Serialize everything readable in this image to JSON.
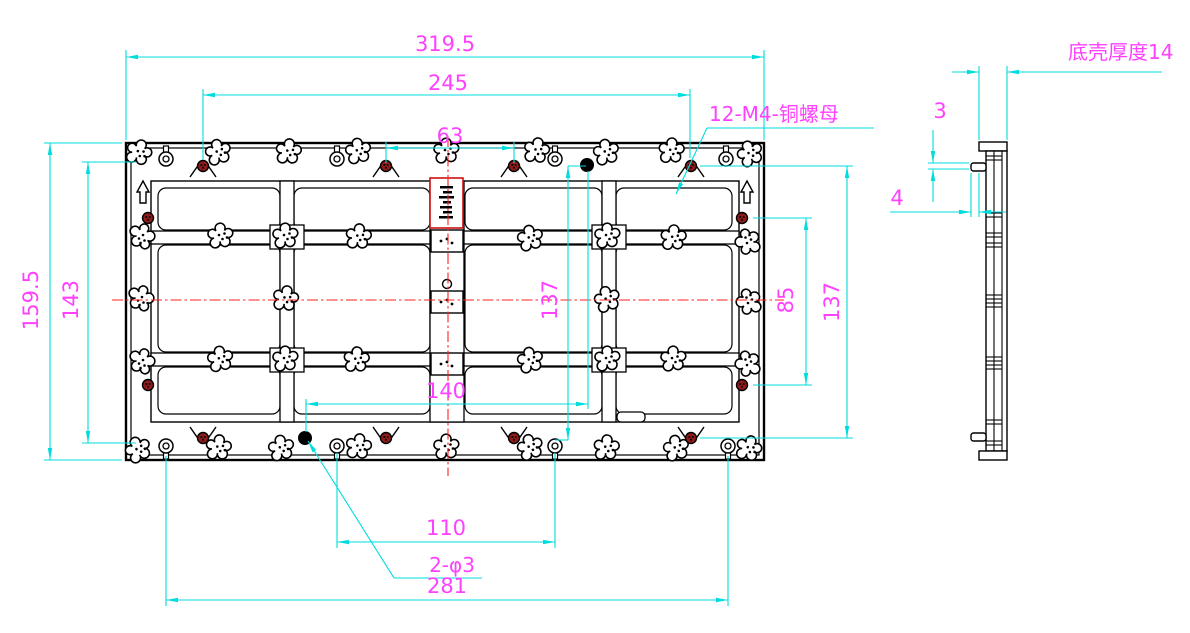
{
  "drawing": {
    "dimensions": {
      "overall_width": "319.5",
      "nut_span_width": "245",
      "center_nut_span": "63",
      "overall_height": "159.5",
      "inner_height": "143",
      "mid_height": "137",
      "right_height": "137",
      "right_nut_span": "85",
      "hole_offset_width": "140",
      "hole_span": "110",
      "bottom_width": "281",
      "side_step": "3",
      "side_pin": "4"
    },
    "labels": {
      "nut_callout": "12-M4-铜螺母",
      "shell_thickness": "底壳厚度14",
      "hole_callout": "2-φ3"
    },
    "colors": {
      "dimension_line": "#00dcdc",
      "dimension_text": "#ff40ff",
      "centerline": "#ff2020",
      "outline": "#000000",
      "nut_fill": "#8f1a1a",
      "highlight_box": "#cc1111"
    }
  }
}
